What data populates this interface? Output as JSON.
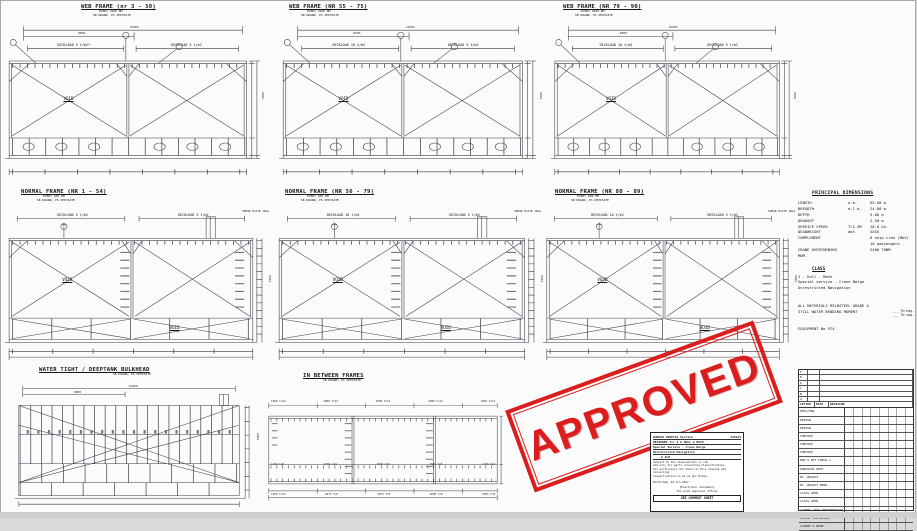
{
  "panels": {
    "web1": {
      "title": "WEB FRAME (nr 3 - 50)",
      "sub1": "EVERY 2400 MM",
      "sub2": "SB DRAWN, PS OPPOSITE",
      "dl_left": "DECKLOAD 5 t/m2*",
      "dl_right": "DECKLOAD 5 t/m2",
      "void1": "VOID",
      "dim_top": "12000",
      "dim_sub": "8000",
      "dim_right": "5000"
    },
    "web2": {
      "title": "WEB FRAME (NR 55 - 75)",
      "sub1": "EVERY 2400 MM",
      "sub2": "SB DRAWN, PS OPPOSITE",
      "dl_left": "DECKLOAD 10 t/m2",
      "dl_right": "DECKLOAD 5 t/m2",
      "void1": "VOID",
      "dim_top": "12000",
      "dim_sub": "8000",
      "dim_right": "5000"
    },
    "web3": {
      "title": "WEB FRAME (NR 79 - 90)",
      "sub1": "EVERY 2400 MM",
      "sub2": "SB DRAWN, PS OPPOSITE",
      "dl_left": "DECKLOAD 10 t/m2",
      "dl_right": "DECKLOAD 5 t/m2",
      "void1": "VOID",
      "dim_top": "12000",
      "dim_sub": "8000",
      "dim_right": "5000"
    },
    "norm1": {
      "title": "NORMAL FRAME (NR 1 - 54)",
      "sub1": "EVERY 600 MM",
      "sub2": "SB DRAWN, PS OPPOSITE",
      "dl_left": "DECKLOAD 5 t/m2",
      "dl_right": "DECKLOAD 5 t/m2",
      "void1": "VOID",
      "void2": "VOID",
      "shear": "SHEAR PLATE 10mm",
      "dim_top": "12000",
      "dim_right": "5000"
    },
    "norm2": {
      "title": "NORMAL FRAME (NR 56 - 79)",
      "sub1": "EVERY 600 MM",
      "sub2": "SB DRAWN, PS OPPOSITE",
      "dl_left": "DECKLOAD 10 t/m2",
      "dl_right": "DECKLOAD 5 t/m2",
      "void1": "VOID",
      "void2": "VOID",
      "shear": "SHEAR PLATE 10mm",
      "dim_top": "12000",
      "dim_right": "5000"
    },
    "norm3": {
      "title": "NORMAL FRAME (NR 80 - 89)",
      "sub1": "EVERY 600 MM",
      "sub2": "SB DRAWN, PS OPPOSITE",
      "dl_left": "DECKLOAD 10 t/m2",
      "dl_right": "DECKLOAD 5 t/m2",
      "void1": "VOID",
      "void2": "VOID",
      "shear": "SHEAR PLATE 10mm",
      "dim_top": "12000",
      "dim_right": "5000"
    },
    "bulkhead": {
      "title": "WATER TIGHT / DEEPTANK BULKHEAD",
      "sub2": "SB DRAWN, PS OPPOSITE",
      "dim_top": "12000",
      "dim_sub": "8000",
      "dim_right": "5000"
    },
    "between": {
      "title": "IN BETWEEN FRAMES",
      "sub2": "SB DRAWN, PS OPPOSITE",
      "top_labels": [
        "1200 t=12",
        "2000 t=12",
        "2000 t=12",
        "2000 t=12",
        "1200 t=12"
      ],
      "mid_labels": [
        "1200 t=8",
        "2000 t=8",
        "2000 t=8",
        "2000 t=8",
        "1200 t=8"
      ],
      "bot_labels": [
        "1200 t=12",
        "2075 t=8",
        "2075 t=8",
        "2000 t=8",
        "1985 t=8"
      ]
    }
  },
  "principal": {
    "heading": "PRINCIPAL DIMENSIONS",
    "rows": [
      {
        "label": "LENGTH",
        "mid": "o.a.",
        "value": "65.00 m"
      },
      {
        "label": "BREADTH",
        "mid": "m.l.d.",
        "value": "24.00 m"
      },
      {
        "label": "DEPTH",
        "mid": "",
        "value": "5.00 m"
      },
      {
        "label": "DRAUGHT",
        "mid": "",
        "value": "2.50 m"
      },
      {
        "label": "SERVICE SPEED",
        "mid": "T=2.5M",
        "value": "10.0 kn."
      },
      {
        "label": "DEADWEIGHT",
        "mid": "abt.",
        "value": "XXXX"
      },
      {
        "label": "COMPLEMENT",
        "mid": "",
        "value": "6 ship crew (MAX)"
      },
      {
        "label": "",
        "mid": "",
        "value": "10 passengers"
      },
      {
        "label": "CRANE OVERTURNING MOM.",
        "mid": "",
        "value": "2400 TONM"
      }
    ]
  },
  "class_block": {
    "heading": "CLASS",
    "lines": [
      "I - Hull - Mach",
      "Special service - Crane Barge",
      "Unrestricted Navigation"
    ]
  },
  "notes": {
    "materials": "ALL MATERIALS MILDSTEEL GRADE A",
    "swbm": "STILL WATER BENDING MOMENT",
    "swbm_hog": "___ Tm hog.",
    "swbm_sag": "___ Tm sag.",
    "equipment": "EQUIPMENT No 974"
  },
  "stamp": {
    "text": "APPROVED",
    "color": "#da1e1e"
  },
  "bv_box": {
    "l1a": "BUREAU VERITAS Section",
    "l1b": "335324",
    "l2": "REVIEWED for   I   ⊕ HULL   ⊕ MACH",
    "l3": "Special Service - Crane Barge",
    "l4": "Unrestricted Navigation",
    "l5": "⊕ ALM",
    "s1": "subject to the observations in red",
    "s2": "and only for parts concerning Classification.",
    "s3": "All particulars not shown on this drawing and concerning",
    "s4": "Classification to be as per Rules.",
    "place": "Rotterdam,  02-Jun-2017",
    "elec": "[Electronic document]",
    "office": "The plan approval office",
    "footer": "SEE COMMENT SHEET"
  },
  "title_block": {
    "rev_letters": [
      "F",
      "E",
      "D",
      "C",
      "B",
      "A"
    ],
    "header": {
      "c1": "LETTER",
      "c2": "DATE",
      "c3": "REVISION"
    },
    "rows": [
      "PROJ/ENG",
      "DESIGN",
      "DESIGN",
      "CHECKED",
      "CHECKED",
      "CHECKED",
      "ENG & DET CHECK L.",
      "PURCHASE DEPT.",
      "WT. WEIGHT",
      "WT. WEIGHT REPR.",
      "CLASS APPR.",
      "CLASS APPR.",
      "CLIENT (FOR INFORMATION)",
      "CLIENT (APPROVAL)",
      "CLIENT'S REPR."
    ]
  }
}
